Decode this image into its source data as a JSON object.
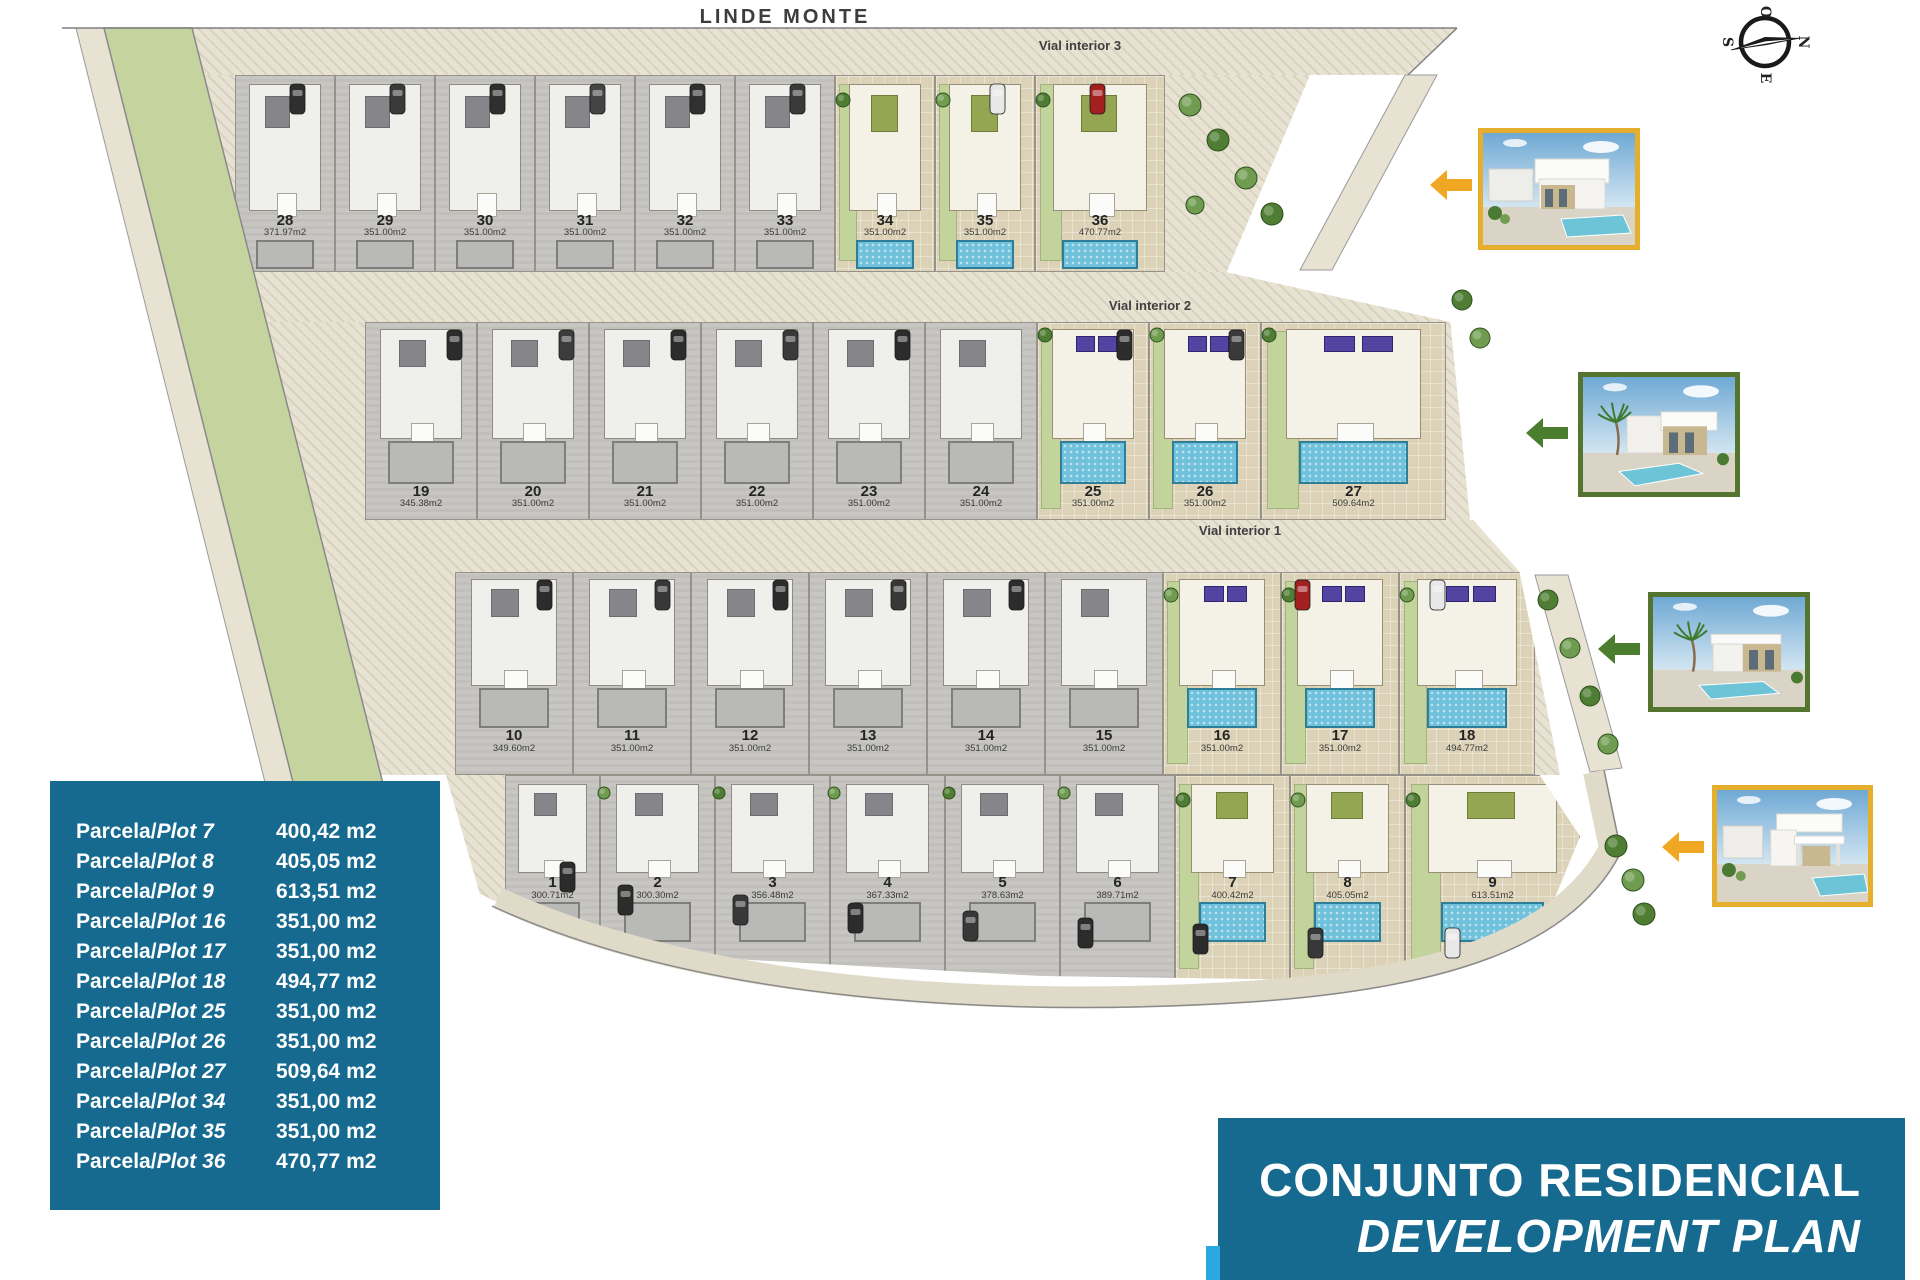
{
  "header": {
    "top_label": "LINDE MONTE"
  },
  "compass": {
    "letters": {
      "top": "O",
      "right": "N",
      "bottom": "E",
      "left": "S"
    }
  },
  "streets": [
    {
      "label": "Vial interior 3"
    },
    {
      "label": "Vial interior 2"
    },
    {
      "label": "Vial interior 1"
    }
  ],
  "plan": {
    "rows": [
      {
        "name": "row-28-36",
        "plots": [
          {
            "n": "28",
            "area": "371.97m2",
            "available": false
          },
          {
            "n": "29",
            "area": "351.00m2",
            "available": false
          },
          {
            "n": "30",
            "area": "351.00m2",
            "available": false
          },
          {
            "n": "31",
            "area": "351.00m2",
            "available": false
          },
          {
            "n": "32",
            "area": "351.00m2",
            "available": false
          },
          {
            "n": "33",
            "area": "351.00m2",
            "available": false
          },
          {
            "n": "34",
            "area": "351.00m2",
            "available": true
          },
          {
            "n": "35",
            "area": "351.00m2",
            "available": true
          },
          {
            "n": "36",
            "area": "470.77m2",
            "available": true
          }
        ]
      },
      {
        "name": "row-19-27",
        "plots": [
          {
            "n": "19",
            "area": "345.38m2",
            "available": false
          },
          {
            "n": "20",
            "area": "351.00m2",
            "available": false
          },
          {
            "n": "21",
            "area": "351.00m2",
            "available": false
          },
          {
            "n": "22",
            "area": "351.00m2",
            "available": false
          },
          {
            "n": "23",
            "area": "351.00m2",
            "available": false
          },
          {
            "n": "24",
            "area": "351.00m2",
            "available": false
          },
          {
            "n": "25",
            "area": "351.00m2",
            "available": true
          },
          {
            "n": "26",
            "area": "351.00m2",
            "available": true
          },
          {
            "n": "27",
            "area": "509.64m2",
            "available": true
          }
        ]
      },
      {
        "name": "row-10-18",
        "plots": [
          {
            "n": "10",
            "area": "349.60m2",
            "available": false
          },
          {
            "n": "11",
            "area": "351.00m2",
            "available": false
          },
          {
            "n": "12",
            "area": "351.00m2",
            "available": false
          },
          {
            "n": "13",
            "area": "351.00m2",
            "available": false
          },
          {
            "n": "14",
            "area": "351.00m2",
            "available": false
          },
          {
            "n": "15",
            "area": "351.00m2",
            "available": false
          },
          {
            "n": "16",
            "area": "351.00m2",
            "available": true
          },
          {
            "n": "17",
            "area": "351.00m2",
            "available": true
          },
          {
            "n": "18",
            "area": "494.77m2",
            "available": true
          }
        ]
      },
      {
        "name": "row-1-9",
        "plots": [
          {
            "n": "1",
            "area": "300.71m2",
            "available": false
          },
          {
            "n": "2",
            "area": "300.30m2",
            "available": false
          },
          {
            "n": "3",
            "area": "356.48m2",
            "available": false
          },
          {
            "n": "4",
            "area": "367.33m2",
            "available": false
          },
          {
            "n": "5",
            "area": "378.63m2",
            "available": false
          },
          {
            "n": "6",
            "area": "389.71m2",
            "available": false
          },
          {
            "n": "7",
            "area": "400.42m2",
            "available": true
          },
          {
            "n": "8",
            "area": "405.05m2",
            "available": true
          },
          {
            "n": "9",
            "area": "613.51m2",
            "available": true
          }
        ]
      }
    ]
  },
  "legend": {
    "label_es": "Parcela",
    "label_en": "Plot",
    "rows": [
      {
        "plot": "7",
        "area": "400,42 m2"
      },
      {
        "plot": "8",
        "area": "405,05 m2"
      },
      {
        "plot": "9",
        "area": "613,51 m2"
      },
      {
        "plot": "16",
        "area": "351,00 m2"
      },
      {
        "plot": "17",
        "area": "351,00 m2"
      },
      {
        "plot": "18",
        "area": "494,77 m2"
      },
      {
        "plot": "25",
        "area": "351,00 m2"
      },
      {
        "plot": "26",
        "area": "351,00 m2"
      },
      {
        "plot": "27",
        "area": "509,64 m2"
      },
      {
        "plot": "34",
        "area": "351,00 m2"
      },
      {
        "plot": "35",
        "area": "351,00 m2"
      },
      {
        "plot": "36",
        "area": "470,77 m2"
      }
    ]
  },
  "title_block": {
    "line1": "CONJUNTO RESIDENCIAL",
    "line2": "DEVELOPMENT PLAN"
  },
  "photos": [
    {
      "name": "villa-photo-1",
      "border": "yellow",
      "arrow": "yellow"
    },
    {
      "name": "villa-photo-2",
      "border": "green",
      "arrow": "green"
    },
    {
      "name": "villa-photo-3",
      "border": "green",
      "arrow": "green"
    },
    {
      "name": "villa-photo-4",
      "border": "yellow",
      "arrow": "yellow"
    }
  ],
  "colors": {
    "panel_teal": "#166a90",
    "accent_cyan": "#29a9e0",
    "border_yellow": "#e5af2d",
    "border_green": "#53752f",
    "arrow_yellow": "#f0a824",
    "arrow_green": "#4a7d2e",
    "pool_blue": "#70c2dc",
    "pool_gray": "#b9b9b7",
    "lawn_green": "#c2d39b",
    "band_green": "#c5d49e",
    "road_beige": "#e8e2d2",
    "solar_purple": "#5444a2",
    "car_red": "#a32020"
  }
}
